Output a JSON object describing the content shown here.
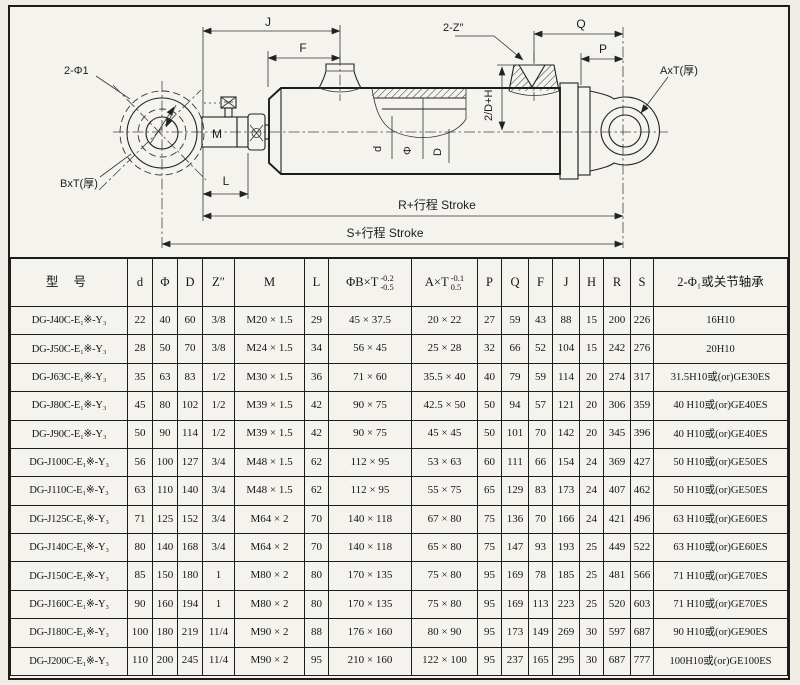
{
  "diagram": {
    "labels": {
      "holes": "2-Φ1",
      "rod_eye_thickness": "BxT(厚)",
      "thread": "M",
      "dim_l": "L",
      "dim_j": "J",
      "dim_f": "F",
      "ports": "2-Z″",
      "half_bore": "2/D+H",
      "bore_d": "d",
      "bore_phi": "Φ",
      "bore_D": "D",
      "cap_eye_thickness": "AxT(厚)",
      "dim_q": "Q",
      "dim_p": "P",
      "dim_r": "R+行程  Stroke",
      "dim_s": "S+行程  Stroke"
    }
  },
  "table": {
    "headers": {
      "model": "型  号",
      "d": "d",
      "phi": "Φ",
      "D": "D",
      "z": "Z″",
      "M": "M",
      "L": "L",
      "bt_label": "ΦB×T",
      "bt_sup": "-0.2",
      "bt_sub": "-0.5",
      "at_label": "A×T",
      "at_sup": "-0.1",
      "at_sub": "0.5",
      "P": "P",
      "Q": "Q",
      "F": "F",
      "J": "J",
      "H": "H",
      "R": "R",
      "S": "S",
      "bearing": "2-Φ₁或关节轴承"
    },
    "rows": [
      [
        "DG-J40C-E₁※-Y₃",
        "22",
        "40",
        "60",
        "3/8",
        "M20 × 1.5",
        "29",
        "45 × 37.5",
        "20 × 22",
        "27",
        "59",
        "43",
        "88",
        "15",
        "200",
        "226",
        "16H10"
      ],
      [
        "DG-J50C-E₁※-Y₃",
        "28",
        "50",
        "70",
        "3/8",
        "M24 × 1.5",
        "34",
        "56 × 45",
        "25 × 28",
        "32",
        "66",
        "52",
        "104",
        "15",
        "242",
        "276",
        "20H10"
      ],
      [
        "DG-J63C-E₁※-Y₃",
        "35",
        "63",
        "83",
        "1/2",
        "M30 × 1.5",
        "36",
        "71 × 60",
        "35.5 × 40",
        "40",
        "79",
        "59",
        "114",
        "20",
        "274",
        "317",
        "31.5H10或(or)GE30ES"
      ],
      [
        "DG-J80C-E₁※-Y₃",
        "45",
        "80",
        "102",
        "1/2",
        "M39 × 1.5",
        "42",
        "90 × 75",
        "42.5 × 50",
        "50",
        "94",
        "57",
        "121",
        "20",
        "306",
        "359",
        "40 H10或(or)GE40ES"
      ],
      [
        "DG-J90C-E₁※-Y₃",
        "50",
        "90",
        "114",
        "1/2",
        "M39 × 1.5",
        "42",
        "90 × 75",
        "45 × 45",
        "50",
        "101",
        "70",
        "142",
        "20",
        "345",
        "396",
        "40 H10或(or)GE40ES"
      ],
      [
        "DG-J100C-E₁※-Y₃",
        "56",
        "100",
        "127",
        "3/4",
        "M48 × 1.5",
        "62",
        "112 × 95",
        "53 × 63",
        "60",
        "111",
        "66",
        "154",
        "24",
        "369",
        "427",
        "50 H10或(or)GE50ES"
      ],
      [
        "DG-J110C-E₁※-Y₃",
        "63",
        "110",
        "140",
        "3/4",
        "M48 × 1.5",
        "62",
        "112 × 95",
        "55 × 75",
        "65",
        "129",
        "83",
        "173",
        "24",
        "407",
        "462",
        "50 H10或(or)GE50ES"
      ],
      [
        "DG-J125C-E₁※-Y₃",
        "71",
        "125",
        "152",
        "3/4",
        "M64 × 2",
        "70",
        "140 × 118",
        "67 × 80",
        "75",
        "136",
        "70",
        "166",
        "24",
        "421",
        "496",
        "63 H10或(or)GE60ES"
      ],
      [
        "DG-J140C-E₁※-Y₃",
        "80",
        "140",
        "168",
        "3/4",
        "M64 × 2",
        "70",
        "140 × 118",
        "65 × 80",
        "75",
        "147",
        "93",
        "193",
        "25",
        "449",
        "522",
        "63 H10或(or)GE60ES"
      ],
      [
        "DG-J150C-E₁※-Y₃",
        "85",
        "150",
        "180",
        "1",
        "M80 × 2",
        "80",
        "170 × 135",
        "75 × 80",
        "95",
        "169",
        "78",
        "185",
        "25",
        "481",
        "566",
        "71 H10或(or)GE70ES"
      ],
      [
        "DG-J160C-E₁※-Y₃",
        "90",
        "160",
        "194",
        "1",
        "M80 × 2",
        "80",
        "170 × 135",
        "75 × 80",
        "95",
        "169",
        "113",
        "223",
        "25",
        "520",
        "603",
        "71 H10或(or)GE70ES"
      ],
      [
        "DG-J180C-E₁※-Y₃",
        "100",
        "180",
        "219",
        "11/4",
        "M90 × 2",
        "88",
        "176 × 160",
        "80 × 90",
        "95",
        "173",
        "149",
        "269",
        "30",
        "597",
        "687",
        "90 H10或(or)GE90ES"
      ],
      [
        "DG-J200C-E₁※-Y₃",
        "110",
        "200",
        "245",
        "11/4",
        "M90 × 2",
        "95",
        "210 × 160",
        "122 × 100",
        "95",
        "237",
        "165",
        "295",
        "30",
        "687",
        "777",
        "100H10或(or)GE100ES"
      ]
    ]
  }
}
